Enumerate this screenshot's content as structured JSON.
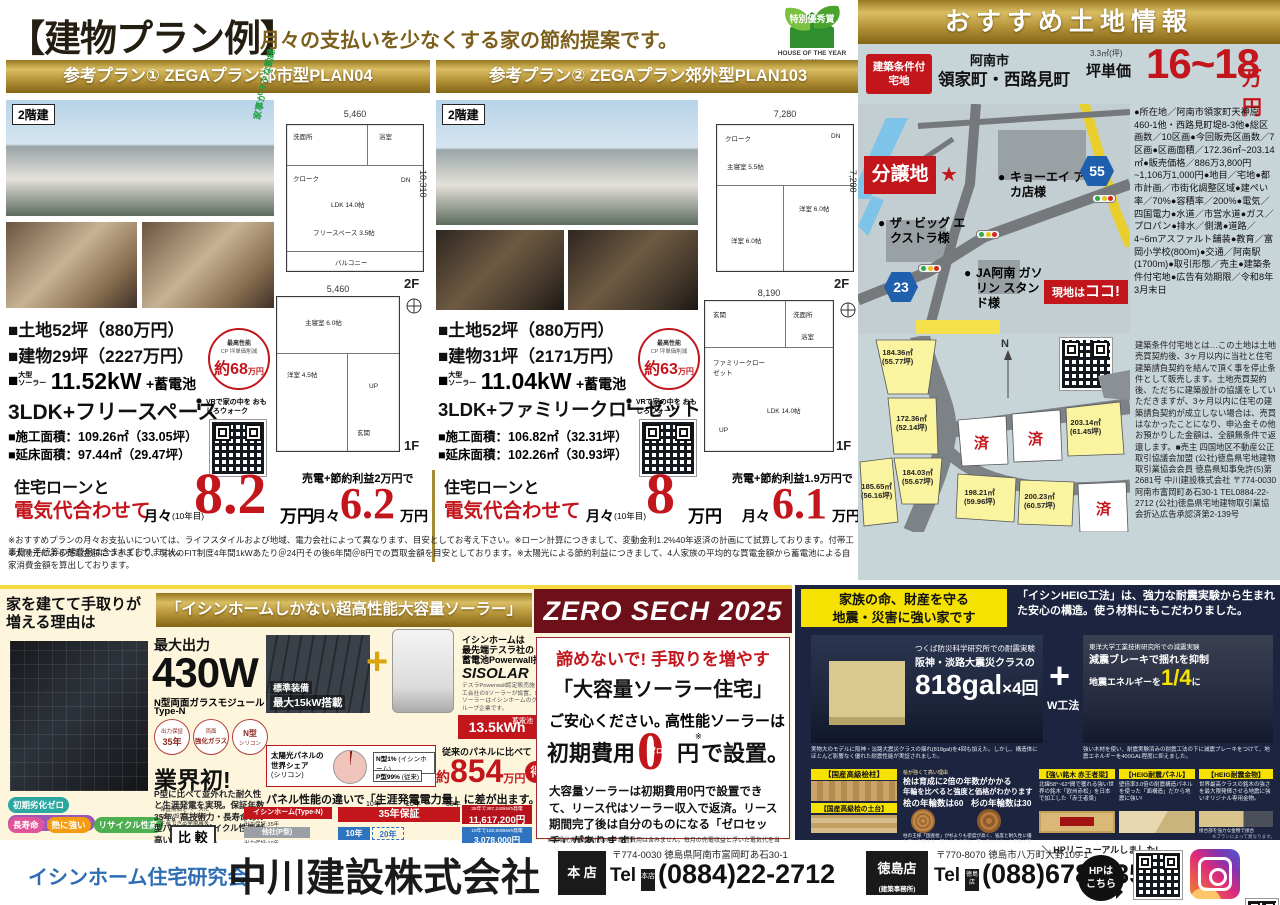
{
  "header": {
    "title": "【建物プラン例】",
    "subtitle": "月々の支払いを少なくする家の節約提案です。",
    "award": {
      "badge": "特別優秀賞",
      "line1": "HOUSE OF THE YEAR",
      "line2": "IN ENERGY",
      "year": "2024"
    }
  },
  "plans": [
    {
      "header": "参考プラン① ZEGAプラン都市型PLAN04",
      "story": "2階建",
      "flow_note": "家事がラクな動線",
      "dim_w": "5,460",
      "dim_h": "10,310",
      "dim_w1f": "5,460",
      "f2": "2F",
      "f1": "1F",
      "rooms_2f": [
        "洗面所",
        "浴室",
        "クローク",
        "DN",
        "LDK 14.0帖",
        "フリースペース 3.5帖",
        "バルコニー"
      ],
      "rooms_1f": [
        "主寝室 6.0帖",
        "洋室 4.5帖",
        "UP",
        "玄関"
      ],
      "spec_land": "■土地52坪（880万円）",
      "spec_bldg": "■建物29坪（2227万円）",
      "solar_label1": "大型",
      "solar_label2": "ソーラー",
      "solar_value": "11.52kW",
      "solar_suffix": "+蓄電池",
      "layout": "3LDK+フリースペース",
      "area1": "■施工面積：109.26㎡（33.05坪）",
      "area2": "■延床面積：97.44㎡（29.47坪）",
      "cp_top": "最高性能",
      "cp_mid": "CP 坪単価削減",
      "cp_value": "約68",
      "cp_unit": "万円",
      "vr": "VRで家の中を おもしろウォーク",
      "pay_label1": "住宅ローンと",
      "pay_label2": "電気代合わせて",
      "pay_monthly": "月々",
      "pay_note": "(10年目)",
      "pay_value": "8.2",
      "pay_unit": "万円",
      "pay_benefit": "売電+節約利益2万円で",
      "pay_monthly2": "月々",
      "pay_value2": "6.2",
      "pay_unit2": "万円"
    },
    {
      "header": "参考プラン② ZEGAプラン郊外型PLAN103",
      "story": "2階建",
      "dim_w": "7,280",
      "dim_h": "7,280",
      "dim_w1f": "8,190",
      "f2": "2F",
      "f1": "1F",
      "rooms_2f": [
        "クローク",
        "主寝室 5.5帖",
        "DN",
        "洋室 6.0帖",
        "洋室 6.0帖"
      ],
      "rooms_1f": [
        "玄関",
        "洗面所",
        "浴室",
        "ファミリークローゼット",
        "LDK 14.0帖",
        "UP"
      ],
      "spec_land": "■土地52坪（880万円）",
      "spec_bldg": "■建物31坪（2171万円）",
      "solar_label1": "大型",
      "solar_label2": "ソーラー",
      "solar_value": "11.04kW",
      "solar_suffix": "+蓄電池",
      "layout": "3LDK+ファミリークローゼット",
      "area1": "■施工面積：106.82㎡（32.31坪）",
      "area2": "■延床面積：102.26㎡（30.93坪）",
      "cp_top": "最高性能",
      "cp_mid": "CP 坪単価削減",
      "cp_value": "約63",
      "cp_unit": "万円",
      "vr": "VRで家の中を おもしろウォーク",
      "pay_label1": "住宅ローンと",
      "pay_label2": "電気代合わせて",
      "pay_monthly": "月々",
      "pay_note": "(10年目)",
      "pay_value": "8",
      "pay_unit": "万円",
      "pay_benefit": "売電+節約利益1.9万円で",
      "pay_monthly2": "月々",
      "pay_value2": "6.1",
      "pay_unit2": "万円"
    }
  ],
  "notes": {
    "line1": "※おすすめプランの月々お支払いについては、ライフスタイルおよび地域、電力会社によって異なります、目安としてお考え下さい。※ローン計算につきまして、変動金利1.2%40年返済の計画にて試算しております。付帯工事費＋手続等の諸費用は含まれておりません。",
    "line2": "※太陽光による売電金額につきまして、現状のFIT制度4年間1kWあたり＠24円その後6年間＠8円での買取金額を目安としております。※太陽光による節約利益につきまして、4人家族の平均的な買電金額から蓄電池による自家消費金額を算出しております。"
  },
  "land": {
    "header": "おすすめ土地情報",
    "badge1": "建築条件付",
    "badge2": "宅地",
    "city": "阿南市",
    "towns": "領家町・西路見町",
    "unit_note": "3.3㎡(坪)",
    "unit_label": "坪単価",
    "price": "16~18",
    "price_unit": "万円",
    "details": "●所在地／阿南市領家町天神原460-1他・西路見町堤8-3他●総区画数／10区画●今回販売区画数／7区画●区画面積／172.36㎡~203.14㎡●販売価格／886万3,800円~1,106万1,000円●地目／宅地●都市計画／市街化調整区域●建ぺい率／70%●容積率／200%●電気／四国電力●水道／市営水道●ガス／プロパン●排水／側溝●道路／4~6mアスファルト舗装●教育／富岡小学校(800m)●交通／阿南駅(1700m)●取引形態／売主●建築条件付宅地●広告有効期限／令和8年3月末日",
    "legal": "建築条件付宅地とは…この土地は土地売買契約後、3ヶ月以内に当社と住宅建築請負契約を結んで頂く事を停止条件として販売します。土地売買契約後、ただちに建築設計の協議をしていただきますが、3ヶ月以内に住宅の建築請負契約が成立しない場合は、売買はなかったことになり、申込金その他お預かりした金額は、全額無条件で返還します。■売主 四国地区不動産公正取引協議会加盟 (公社)徳島県宅地建物取引業協会会員 徳島県知事免許(5)第2681号 中川建設株式会社 〒774-0030 阿南市富岡町あ石30-1 TEL0884-22-2712 (公社)徳島県宅地建物取引業協会折込広告承認済第2-139号",
    "map": {
      "subdivision": "分譲地",
      "place1": "キョーエイ アピカ店様",
      "place2": "ザ・ビッグ エクストラ様",
      "place3": "JA阿南 ガソリン スタンド様",
      "route1": "55",
      "route2": "23",
      "here1": "現地は",
      "here2": "ココ!"
    },
    "lots": [
      {
        "area": "184.36㎡",
        "tsubo": "(55.77坪)"
      },
      {
        "area": "172.36㎡",
        "tsubo": "(52.14坪)"
      },
      {
        "area": "184.03㎡",
        "tsubo": "(55.67坪)"
      },
      {
        "area": "185.65㎡",
        "tsubo": "(56.16坪)"
      },
      {
        "area": "198.21㎡",
        "tsubo": "(59.96坪)"
      },
      {
        "area": "200.23㎡",
        "tsubo": "(60.57坪)"
      },
      {
        "area": "203.14㎡",
        "tsubo": "(61.45坪)"
      }
    ],
    "sold": "済",
    "north": "N"
  },
  "solar": {
    "reason1": "家を建てて手取りが",
    "reason2": "増える理由は",
    "banner": "「イシンホームしかない超高性能大容量ソーラー」",
    "max_label": "最大出力",
    "max_value": "430W",
    "module": "N型両面ガラスモジュール",
    "module2": "Type-N",
    "c1a": "出力保証",
    "c1b": "35年",
    "c2a": "両面",
    "c2b": "強化ガラス",
    "c3a": "N型",
    "c3b": "シリコン",
    "first": "業界初!",
    "desc": "P型に比べて並外れた耐久性と生涯発電を実現。保証年数35年。高技術力・長寿命のN型パネル。リサイクル性能が高い両面ガラス。",
    "tags": [
      "初期劣化ゼロ",
      "紫外線・水にも強い",
      "長寿命",
      "熱に強い",
      "リサイクル性高"
    ],
    "standard1": "標準装備",
    "standard2": "最大15kW搭載",
    "plus": "+",
    "tesla1": "イシンホームは",
    "tesla2": "最先端テスラ社の",
    "tesla3": "蓄電池Powerwall採用",
    "sisolar": "SISOLAR",
    "tesla_note": "テスラPowerwall認定販売施工会社の9ソーラーが設置、9ソーラーはイシンホームのグループ企業です。",
    "battery_label": "蓄電池",
    "battery": "13.5kWh",
    "pie_title1": "太陽光パネルの",
    "pie_title2": "世界シェア",
    "pie_title3": "(シリコン)",
    "pie_p": "P型99%",
    "pie_p_note": "(従来)",
    "pie_n": "N型1%",
    "pie_n_note": "(イシンホーム)",
    "save_label": "従来のパネルに比べて",
    "save_pre": "約",
    "save_value": "854",
    "save_unit": "万円",
    "save_toku": "得",
    "diff": "パネル性能の違いで「生涯発電電力量」に差が出ます。",
    "cmp_note1": "保証期間をベースに",
    "cmp_note2": "10kW設置した時の",
    "cmp_note3": "生産できる発電量を",
    "cmp_label": "比 較",
    "cmp_ishin": "イシンホーム(Type-N)",
    "cmp_ishin3": "出力保証:35年",
    "cmp_other": "他社(P型)",
    "cmp_other3": "出力保証:10年",
    "cmp_bar1": "35年保証",
    "cmp_total1a": "35年で387,240kWh発電",
    "cmp_total1b": "11,617,200円",
    "cmp_bar2a": "10年",
    "cmp_bar2b": "20年",
    "cmp_total2a": "10年で102,600kWh発電",
    "cmp_total2b": "3,078,000円",
    "timeline": [
      "10年",
      "20年",
      "30年"
    ]
  },
  "zero": {
    "header": "ZERO SECH 2025",
    "catch": "諦めないで! 手取りを増やす",
    "title": "「大容量ソーラー住宅」",
    "sub1": "ご安心ください。",
    "sub2": "高性能ソーラーは",
    "init1": "初期費用",
    "zero": "0",
    "zero_ruby": "ゼロ",
    "init2": "円",
    "init_note": "※",
    "init3": "で設置。",
    "body": "大容量ソーラーは初期費用0円で設置できて、リース代はソーラー収入で返済。リース期間完了後は自分のものになる「ゼロセッチ」があります!",
    "fine": "※太陽光発電設備代のみ、設置費用は含みません。毎月の売電収益と浮いた電気代を当初10年間リース料金のお支払に活用します。予測より多く発電した場合はその後のお支払いの予備費やメンテナンス費として、貯蓄していただけます。逆に、日照時間や季節の影響で発電量が少ない場合や、電気の使用量が多い場合は、リース料金が経済効果を上回る場合がございます。"
  },
  "quake": {
    "label1": "家族の命、財産を守る",
    "label2": "地震・災害に強い家です",
    "headline": "「イシンHEIG工法」は、強力な耐震実験から生まれた安心の構造。使う材料にもこだわりました。",
    "exp1a": "つくば防災科学研究所での耐震実験",
    "exp1b": "阪神・淡路大震災クラスの",
    "gal": "818gal",
    "gal_times": "×4回",
    "plus": "+",
    "w": "W工法",
    "exp2a": "東洋大学工業技術研究所での減震実験",
    "exp2b": "減震ブレーキで揺れを抑制",
    "exp2c": "地震エネルギーを",
    "exp2d": "1/4",
    "exp2e": "に",
    "note1": "実物大のモデルに阪神・淡路大震災クラスの揺れ(818gal)を4回も加えた。しかし、構造体にほとんど影響なく優れた耐震性能が実証されました。",
    "note2": "強い木材を使い、耐震実験済みの耐震工法の下に減震ブレーキをつけて、地震エネルギーを400GAL程度に抑えました。",
    "card1": "【国産高級桧柱】",
    "card2": "【国産高級桧の土台】",
    "hinoki0": "桧が強くて高い理由",
    "hinoki1": "桧は育成に2倍の年数がかかる",
    "hinoki2": "年輪を比べると強度と価格がわかります",
    "hinoki3a": "桧の年輪数は60",
    "hinoki3b": "杉の年輪数は30",
    "hinoki_note": "柱の王様「国産桧」が杉よりも密度が高く、強度と耐久性に優れている理由は、同じ大きさでも、育つのにかかった年数が違うからです。",
    "card3": "【強い銘木 赤王者梁】",
    "card3_note": "北緯58°~62°間で獲れる強い世界の銘木「欧州赤松」を日本で加工した「赤王者梁」",
    "card4": "【HEIG耐震パネル】",
    "card4_note": "壁倍率3.0倍の耐震構造パネルを使った「面構造」だから地震に強い!",
    "card5": "【HEIG耐震金物】",
    "card5_note": "世界最高クラスの銘木の強さを最大限発揮させる地震に強いオリジナル専用金物。",
    "joint_note": "接合部を強力な金物で接合",
    "plan_note": "※プランによって異なります。"
  },
  "footer": {
    "org": "イシンホーム住宅研究会",
    "company": "中川建設株式会社",
    "store1": "本 店",
    "addr1": "〒774-0030 徳島県阿南市富岡町あ石30-1",
    "tel_label": "Tel",
    "tel1_tag": "本店",
    "tel1": "(0884)22-2712",
    "store2": "徳島店",
    "store2_note": "(建築事務所)",
    "addr2": "〒770-8070 徳島市八万町大野109-1",
    "tel2_tag": "徳島店",
    "tel2": "(088)678-7357",
    "hp_note": "＼ HPリニューアルしました! ／",
    "hp_btn1": "HPは",
    "hp_btn2": "こちら"
  }
}
